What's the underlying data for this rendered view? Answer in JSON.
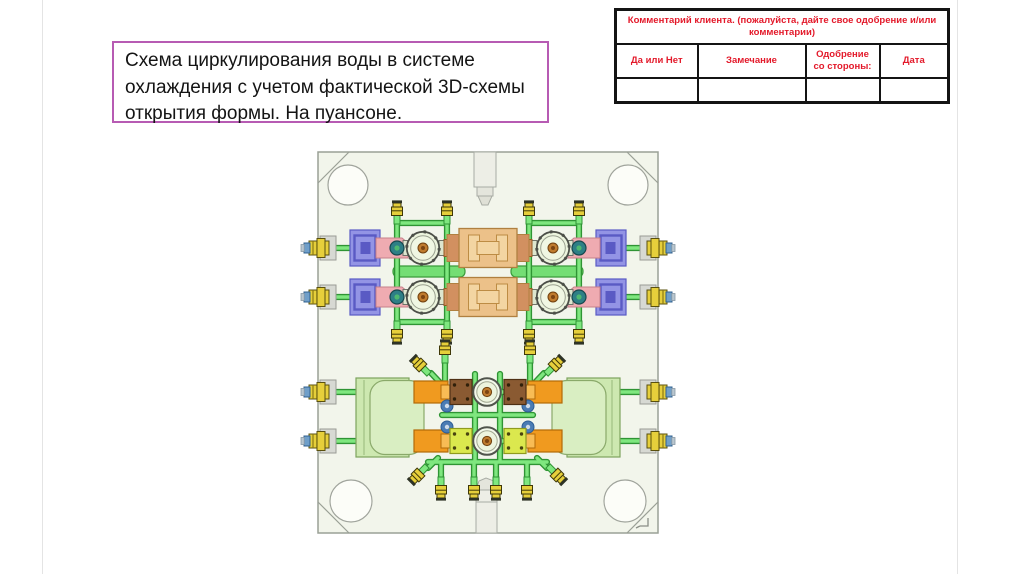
{
  "slide": {
    "title_box": {
      "lines": [
        "Схема циркулирования воды в системе",
        "охлаждения с учетом фактической 3D-схемы",
        "открытия формы. На пуансоне."
      ]
    },
    "comment_table": {
      "header": "Комментарий клиента. (пожалуйста, дайте свое одобрение и/или комментарии)",
      "columns": [
        "Да или Нет",
        "Замечание",
        "Одобрение со стороны:",
        "Дата"
      ],
      "values": [
        "",
        "",
        "",
        ""
      ]
    },
    "diagram": {
      "description": "Вид сверху плиты пуансона пресс-формы со схемой циркуляции охлаждающей воды (зелёные трубки, жёлтые штуцеры)"
    }
  },
  "theme": {
    "title_border": "#b75bb3",
    "table_red": "#e3192a",
    "table_border": "#141414",
    "slide_edge": "#e4e4e4",
    "plate_fill": "#f2f5eb",
    "plate_line": "#9aa096",
    "pipe_outer": "#2f9434",
    "pipe_inner": "#7fe77f",
    "bar_green": "#74de74",
    "bar_green_dark": "#3a9a3a",
    "fit_yellow": "#e6cf3b",
    "fit_dark": "#3f3808",
    "fit_blue": "#6f9fc9",
    "bracket": "#d7d9d3",
    "purple": "#9394e5",
    "purple_dark": "#5a5ac4",
    "pink": "#efabb1",
    "pink_dark": "#c5808a",
    "teal": "#2e7f86",
    "ring_fill": "#ecf4dd",
    "ring_line": "#4c4f48",
    "tan": "#ecc189",
    "tan_dark": "#d29060",
    "tan_line": "#b08040",
    "tan_inner": "#f3d5a2",
    "orange": "#f09a1f",
    "orange_dark": "#b26a08",
    "brown": "#8a5a32",
    "brown_line": "#4f3014",
    "lime": "#dbe84e",
    "lime_line": "#8f9a1e",
    "green_block": "#cde8b0",
    "green_block_line": "#7da35e",
    "green_block_inner": "#d9eec2",
    "metal": "#edeee6",
    "metal_line": "#a8aca4",
    "center_brown": "#bf7b2e",
    "center_brown_line": "#70400e",
    "elbow": "#4b7cb4"
  }
}
